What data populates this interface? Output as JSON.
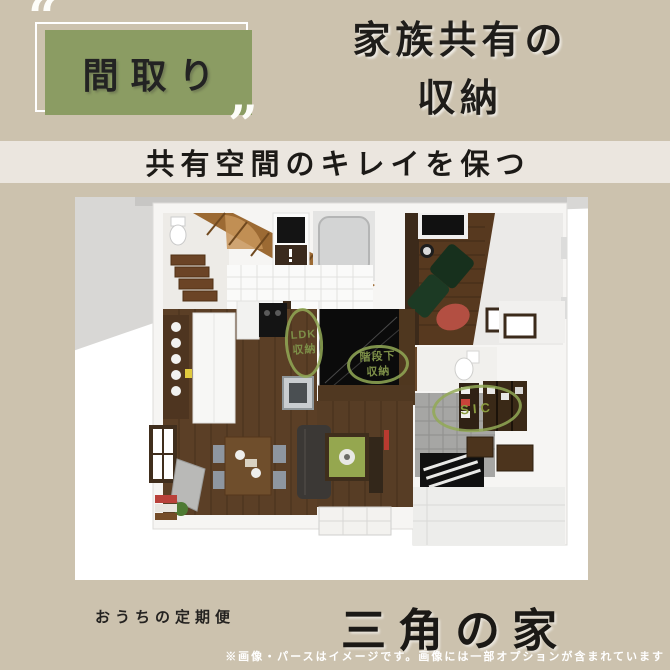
{
  "header": {
    "quote_open": "“",
    "quote_close": "”",
    "badge_label": "間取り",
    "title_line1": "家族共有の",
    "title_line2": "収納"
  },
  "subtitle_banner": {
    "text": "共有空間のキレイを保つ"
  },
  "floorplan": {
    "labels": [
      {
        "id": "ldk-storage",
        "line1": "LDK",
        "line2": "収納"
      },
      {
        "id": "under-stairs",
        "line1": "階段下",
        "line2": "収納"
      },
      {
        "id": "sic",
        "line1": "SIC",
        "line2": ""
      }
    ]
  },
  "footer": {
    "brand": "おうちの定期便",
    "title": "三角の家",
    "disclaimer": "※画像・パースはイメージです。画像には一部オプションが含まれています"
  },
  "colors": {
    "background": "#ccc2ae",
    "accent_green": "#8b9c63",
    "banner": "#ebe6df",
    "label_green": "#7d8f48",
    "wood_dark": "#5b3f26",
    "text_dark": "#1f1d1a"
  }
}
